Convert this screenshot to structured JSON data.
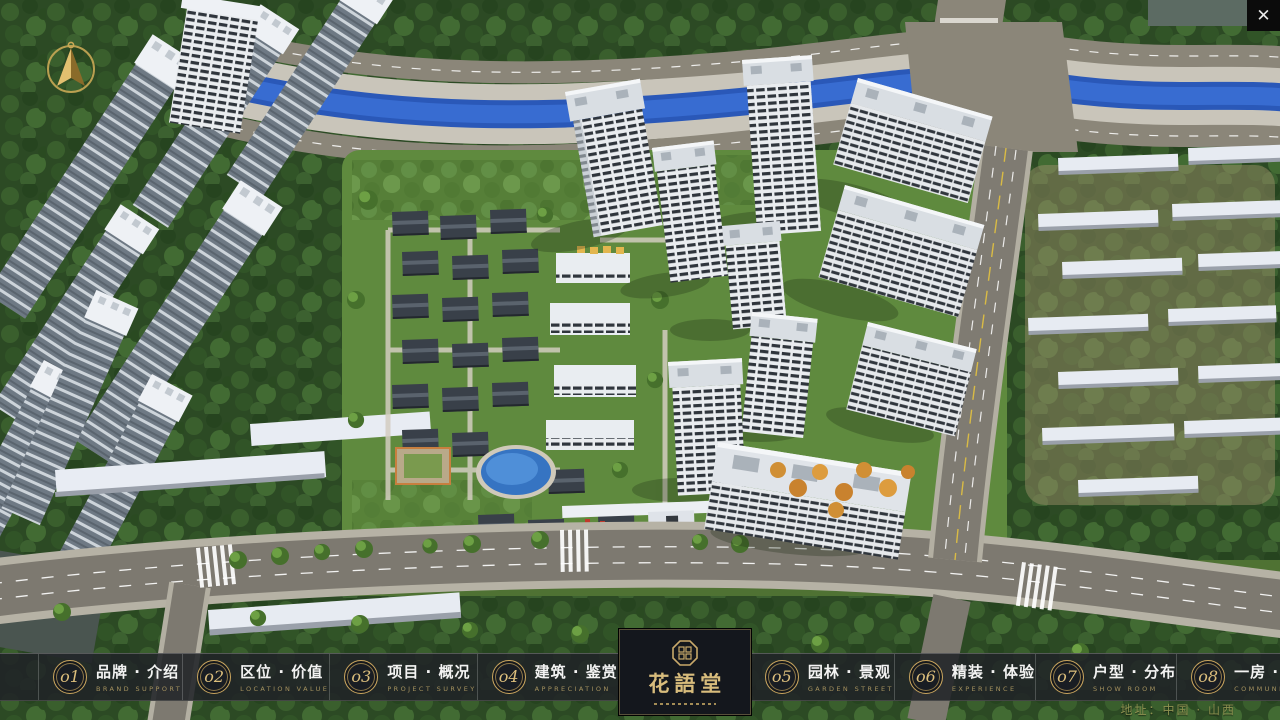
{
  "window": {
    "close_icon": "✕"
  },
  "logo": {
    "title": "花語堂"
  },
  "nav": {
    "items": [
      {
        "num": "o1",
        "zh": "品牌 · 介绍",
        "en": "BRAND SUPPORT"
      },
      {
        "num": "o2",
        "zh": "区位 · 价值",
        "en": "LOCATION VALUE"
      },
      {
        "num": "o3",
        "zh": "项目 · 概况",
        "en": "PROJECT SURVEY"
      },
      {
        "num": "o4",
        "zh": "建筑 · 鉴赏",
        "en": "APPRECIATION"
      },
      {
        "num": "o5",
        "zh": "园林 · 景观",
        "en": "GARDEN STREET"
      },
      {
        "num": "o6",
        "zh": "精装 · 体验",
        "en": "EXPERIENCE"
      },
      {
        "num": "o7",
        "zh": "户型 · 分布",
        "en": "SHOW ROOM"
      },
      {
        "num": "o8",
        "zh": "一房 · 一景",
        "en": "COMMUNITY"
      }
    ]
  },
  "footer": {
    "address": "地址：中国 · 山西"
  },
  "colors": {
    "accent_gold": "#c9a96a",
    "bar_background": "rgba(32,34,39,0.87)",
    "canal_blue": "#2f62c4",
    "road_grey": "#7d7970",
    "forest_green": "#2c4a24",
    "lawn_green": "#5f8a3e",
    "tower_white": "#e9ecef",
    "autumn_orange": "#d08f35",
    "car_red": "#bf362b"
  }
}
